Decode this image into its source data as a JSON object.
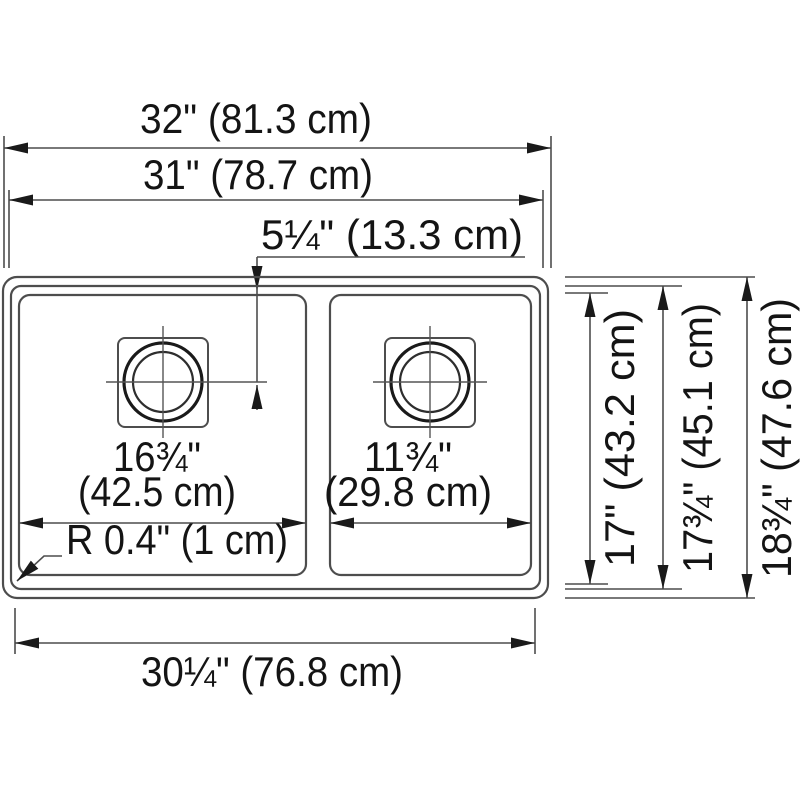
{
  "colors": {
    "background": "#ffffff",
    "line": "#4d4d4d",
    "text": "#141414",
    "arrow": "#1a1a1a"
  },
  "labels": {
    "overall_width": "32\" (81.3 cm)",
    "rim_width": "31\" (78.7 cm)",
    "drain_offset": "5¼\" (13.3 cm)",
    "left_bowl_width_in": "16¾\"",
    "left_bowl_width_cm": "(42.5 cm)",
    "right_bowl_width_in": "11¾\"",
    "right_bowl_width_cm": "(29.8 cm)",
    "corner_radius": "R 0.4\" (1 cm)",
    "bottom_width": "30¼\" (76.8 cm)",
    "bowl_depth": "17\" (43.2 cm)",
    "rim_depth": "17¾\" (45.1 cm)",
    "overall_depth": "18¾\" (47.6 cm)"
  }
}
